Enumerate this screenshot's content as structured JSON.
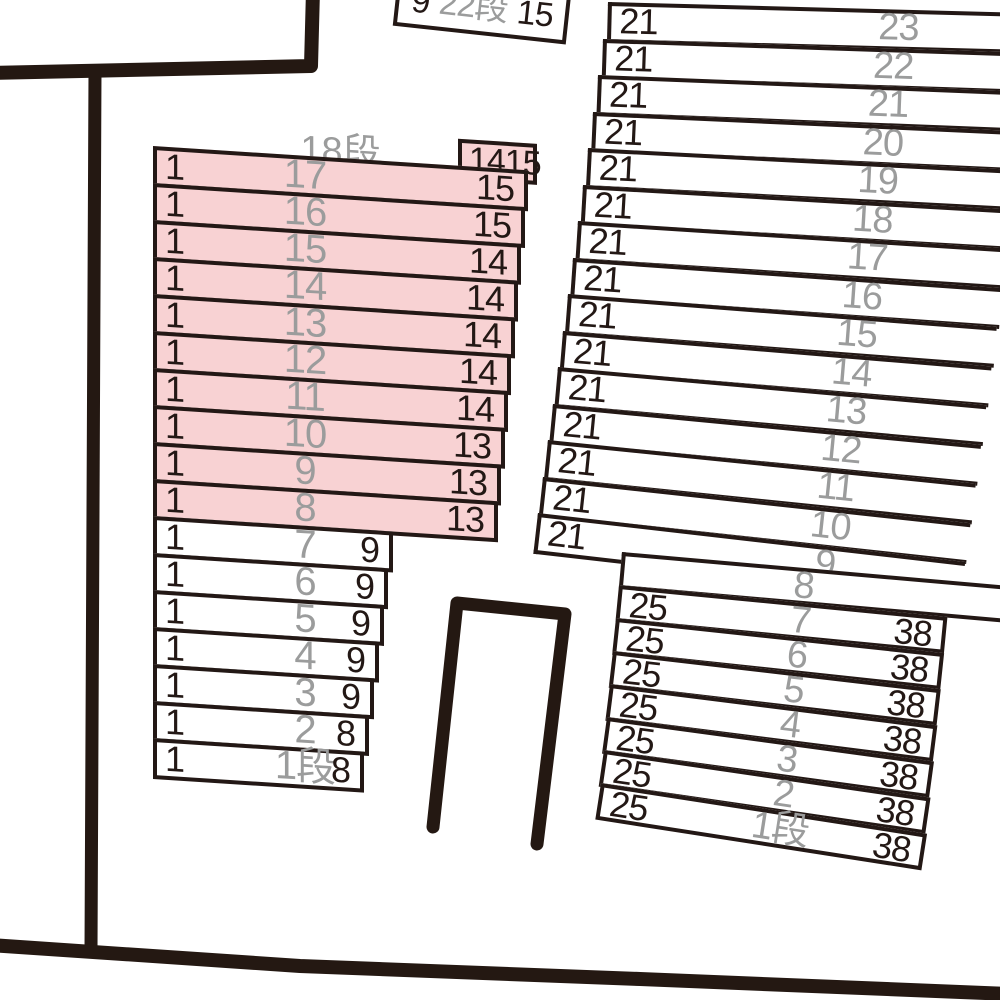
{
  "palette": {
    "line_color": "#231815",
    "gray_label_color": "#9b9c9c",
    "highlight_pink": "#f8d2d3",
    "background": "#ffffff"
  },
  "top_box": {
    "left": "9",
    "center": "22段",
    "right": "15"
  },
  "left_block": {
    "title": "18段",
    "corner_box": {
      "left": "14",
      "right": "15"
    },
    "rows": [
      {
        "left": "1",
        "center": "17",
        "right": "15",
        "highlighted": true
      },
      {
        "left": "1",
        "center": "16",
        "right": "15",
        "highlighted": true
      },
      {
        "left": "1",
        "center": "15",
        "right": "14",
        "highlighted": true
      },
      {
        "left": "1",
        "center": "14",
        "right": "14",
        "highlighted": true
      },
      {
        "left": "1",
        "center": "13",
        "right": "14",
        "highlighted": true
      },
      {
        "left": "1",
        "center": "12",
        "right": "14",
        "highlighted": true
      },
      {
        "left": "1",
        "center": "11",
        "right": "14",
        "highlighted": true
      },
      {
        "left": "1",
        "center": "10",
        "right": "13",
        "highlighted": true
      },
      {
        "left": "1",
        "center": "9",
        "right": "13",
        "highlighted": true
      },
      {
        "left": "1",
        "center": "8",
        "right": "13",
        "highlighted": true
      },
      {
        "left": "1",
        "center": "7",
        "right": "9",
        "highlighted": false
      },
      {
        "left": "1",
        "center": "6",
        "right": "9",
        "highlighted": false
      },
      {
        "left": "1",
        "center": "5",
        "right": "9",
        "highlighted": false
      },
      {
        "left": "1",
        "center": "4",
        "right": "9",
        "highlighted": false
      },
      {
        "left": "1",
        "center": "3",
        "right": "9",
        "highlighted": false
      },
      {
        "left": "1",
        "center": "2",
        "right": "8",
        "highlighted": false
      },
      {
        "left": "1",
        "center": "1段",
        "right": "8",
        "highlighted": false
      }
    ]
  },
  "right_upper_block": {
    "rows": [
      {
        "left": "21",
        "center": "23",
        "right": ""
      },
      {
        "left": "21",
        "center": "22",
        "right": ""
      },
      {
        "left": "21",
        "center": "21",
        "right": ""
      },
      {
        "left": "21",
        "center": "20",
        "right": ""
      },
      {
        "left": "21",
        "center": "19",
        "right": ""
      },
      {
        "left": "21",
        "center": "18",
        "right": ""
      },
      {
        "left": "21",
        "center": "17",
        "right": ""
      },
      {
        "left": "21",
        "center": "16",
        "right": ""
      },
      {
        "left": "21",
        "center": "15",
        "right": ""
      },
      {
        "left": "21",
        "center": "14",
        "right": ""
      },
      {
        "left": "21",
        "center": "13",
        "right": ""
      },
      {
        "left": "21",
        "center": "12",
        "right": ""
      },
      {
        "left": "21",
        "center": "11",
        "right": ""
      },
      {
        "left": "21",
        "center": "10",
        "right": ""
      },
      {
        "left": "21",
        "center": "9",
        "right": ""
      }
    ]
  },
  "right_lower_block": {
    "rows": [
      {
        "left": "",
        "center": "8",
        "right": ""
      },
      {
        "left": "25",
        "center": "7",
        "right": "38"
      },
      {
        "left": "25",
        "center": "6",
        "right": "38"
      },
      {
        "left": "25",
        "center": "5",
        "right": "38"
      },
      {
        "left": "25",
        "center": "4",
        "right": "38"
      },
      {
        "left": "25",
        "center": "3",
        "right": "38"
      },
      {
        "left": "25",
        "center": "2",
        "right": "38"
      },
      {
        "left": "25",
        "center": "1段",
        "right": "38"
      }
    ]
  }
}
